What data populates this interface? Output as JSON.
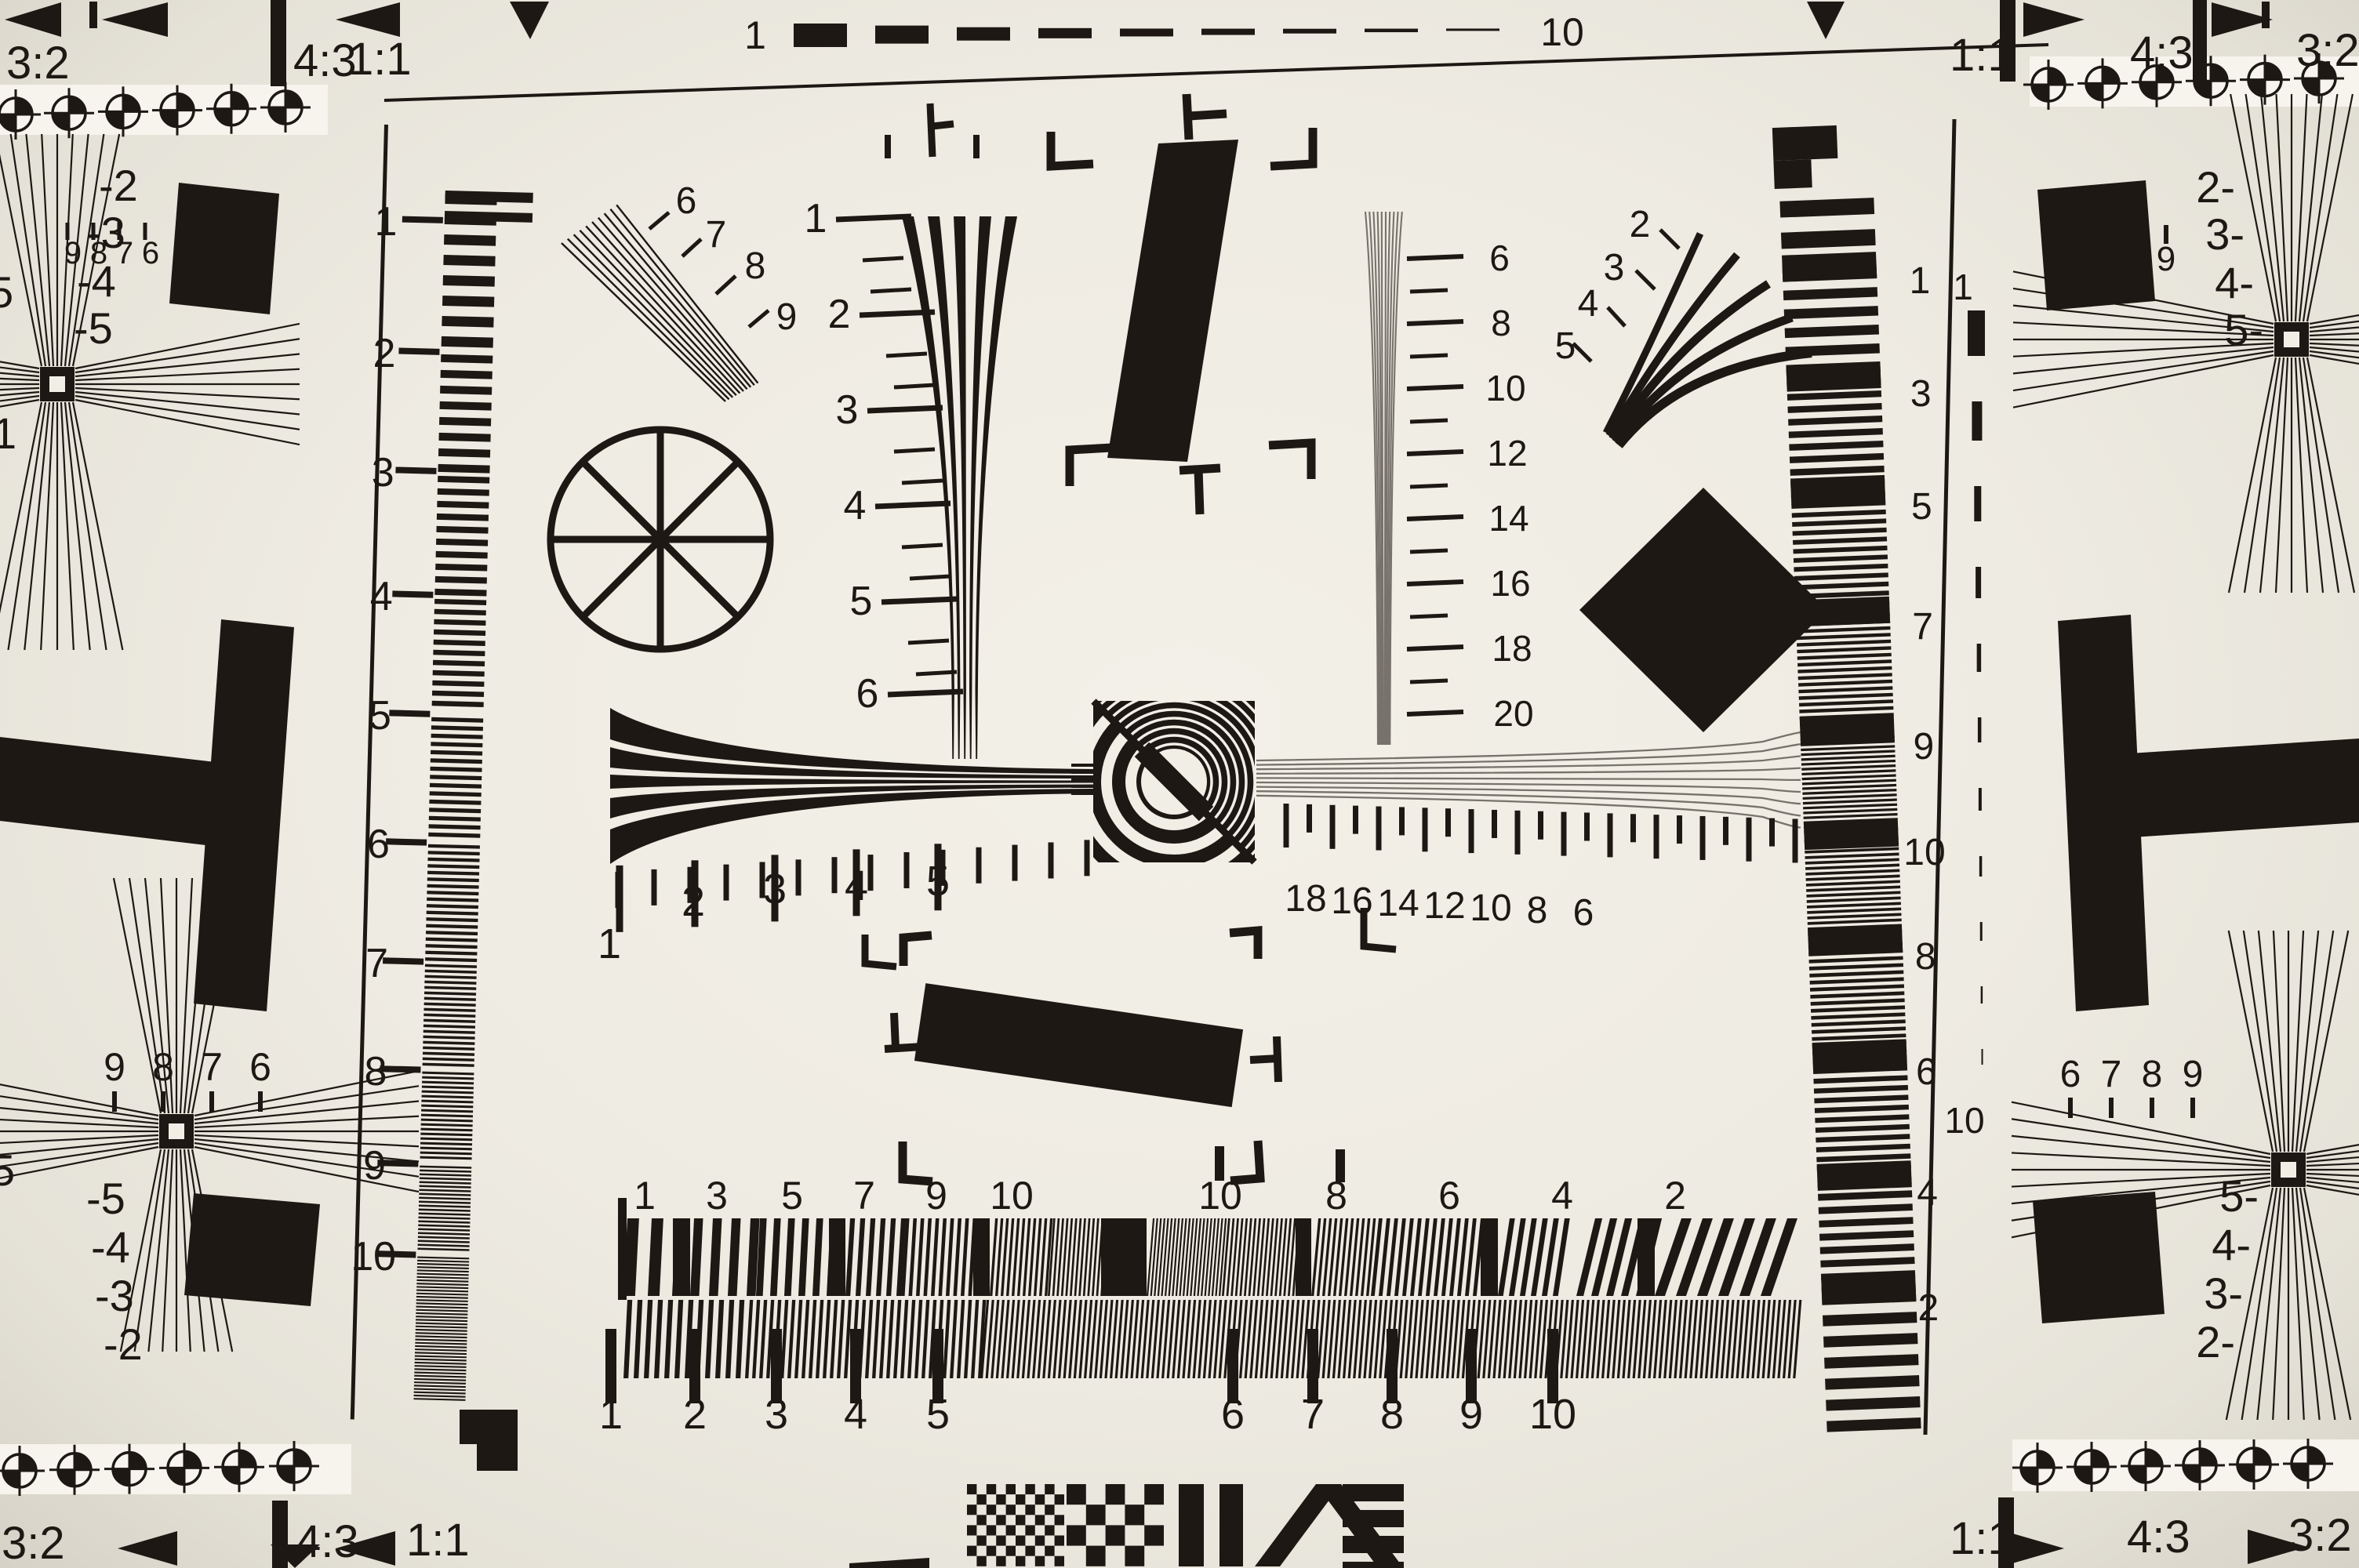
{
  "meta": {
    "subject": "camera resolution test chart photograph"
  },
  "colors": {
    "paper": "#eeebe2",
    "ink": "#1d1813",
    "gray_wedge": "#77726b",
    "band": "#f6f4ec"
  },
  "top_edge": {
    "left": {
      "r32": "3:2",
      "r43": "4:3",
      "r11": "1:1"
    },
    "gauge": {
      "start": "1",
      "end": "10"
    },
    "right": {
      "r11": "1:1",
      "r43": "4:3",
      "r32": "3:2"
    }
  },
  "bottom_edge": {
    "left": {
      "r32": "3:2",
      "r43": "4:3",
      "r11": "1:1"
    },
    "right": {
      "r11": "1:1",
      "r43": "4:3",
      "r32": "3:2"
    }
  },
  "left_ruler": {
    "labels": [
      "1",
      "2",
      "3",
      "4",
      "5",
      "6",
      "7",
      "8",
      "9",
      "10"
    ]
  },
  "wedges": {
    "center_vertical": {
      "labels": [
        "1",
        "2",
        "3",
        "4",
        "5",
        "6"
      ]
    },
    "gray_vertical": {
      "labels": [
        "6",
        "8",
        "10",
        "12",
        "14",
        "16",
        "18",
        "20"
      ]
    },
    "center_left": {
      "labels": [
        "1",
        "2",
        "3",
        "4",
        "5"
      ]
    },
    "center_right": {
      "labels": [
        "18",
        "16",
        "14",
        "12",
        "10",
        "8",
        "6"
      ]
    },
    "diagonal_fan": {
      "labels": [
        "6",
        "7",
        "8",
        "9"
      ]
    },
    "curved_fan": {
      "labels": [
        "2",
        "3",
        "4",
        "5"
      ]
    }
  },
  "bottom_bars": {
    "top_labels": [
      "1",
      "3",
      "5",
      "7",
      "9",
      "10",
      "10",
      "8",
      "6",
      "4",
      "2"
    ],
    "bottom_labels": [
      "1",
      "2",
      "3",
      "4",
      "5",
      "6",
      "7",
      "8",
      "9",
      "10"
    ]
  },
  "right_strip": {
    "labels": [
      "1",
      "3",
      "5",
      "7",
      "9",
      "10",
      "8",
      "6",
      "4",
      "2"
    ]
  },
  "right_gauge": {
    "start": "1",
    "end": "10"
  },
  "corners": {
    "top_left": {
      "numbers": [
        "9",
        "8",
        "7",
        "6"
      ],
      "stops": [
        "-2",
        "-3",
        "-4",
        "-5"
      ],
      "edge_partials": [
        "5",
        "1"
      ]
    },
    "bottom_left": {
      "numbers": [
        "9",
        "8",
        "7",
        "6"
      ],
      "stops": [
        "-5",
        "-4",
        "-3",
        "-2"
      ],
      "edge_partials": [
        "5"
      ]
    },
    "top_right": {
      "numbers": [
        "6",
        "7",
        "8",
        "9"
      ],
      "stops": [
        "2-",
        "3-",
        "4-",
        "5-"
      ]
    },
    "bottom_right": {
      "numbers": [
        "6",
        "7",
        "8",
        "9"
      ],
      "stops": [
        "5-",
        "4-",
        "3-",
        "2-"
      ]
    }
  }
}
